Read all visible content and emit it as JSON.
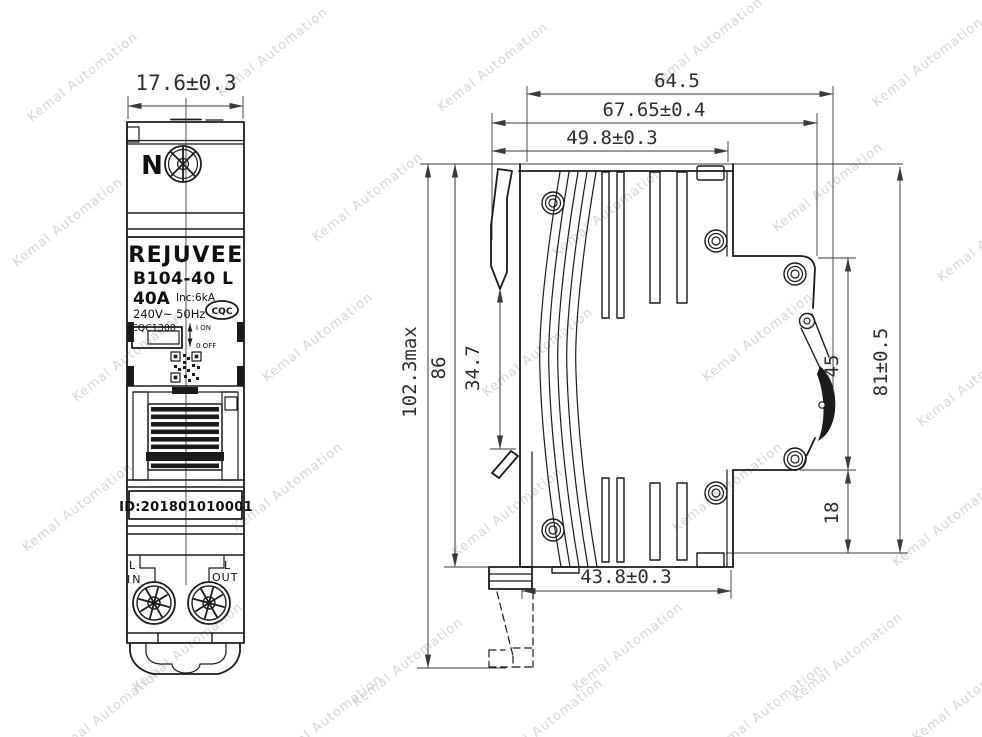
{
  "watermark": {
    "text": "Kemal Automation"
  },
  "front_view": {
    "width_dim": "17.6±0.3",
    "neutral_terminal": "N",
    "brand": "REJUVEE",
    "model": "B104-40 L",
    "rated_current": "40A",
    "breaking_capacity": "Inc:6kA",
    "voltage_frequency": "240V~ 50Hz",
    "cqc_mark": "CQC",
    "cert_number": "CQC1308",
    "switch_on_label": "I ON",
    "switch_off_label": "0 OFF",
    "id_number": "ID:201801010001",
    "input_phase": "L",
    "input_label": "IN",
    "output_phase": "L",
    "output_label": "OUT"
  },
  "side_view": {
    "dim_depth_64_5": "64.5",
    "dim_depth_overall": "67.65±0.4",
    "dim_depth_body": "49.8±0.3",
    "dim_height_max": "102.3max",
    "dim_height_body": "86",
    "dim_din_slot": "34.7",
    "dim_front_45": "45",
    "dim_height_81": "81±0.5",
    "dim_bottom_18": "18",
    "dim_depth_bottom": "43.8±0.3"
  },
  "colors": {
    "outline": "#1b1b1b",
    "dimension": "#3a3a3a",
    "watermark": "#c6c6c6",
    "background": "#ffffff"
  }
}
